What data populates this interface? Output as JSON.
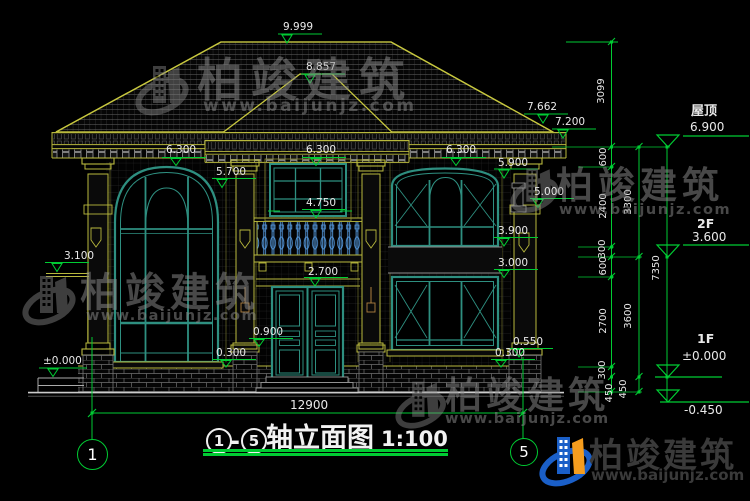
{
  "title_block": {
    "axis_start": "1",
    "axis_end": "5",
    "separator": "-",
    "name": "轴立面图",
    "scale": "1:100"
  },
  "axis_bubbles": {
    "left": "1",
    "right": "5"
  },
  "overall_dimension": "12900",
  "levels": [
    {
      "name": "屋顶",
      "elevation": "6.900"
    },
    {
      "name": "2F",
      "elevation": "3.600"
    },
    {
      "name": "1F",
      "elevation": "±0.000"
    },
    {
      "name": "",
      "elevation": "-0.450"
    }
  ],
  "dimension_chains": {
    "inner": [
      "600",
      "2400",
      "300",
      "600",
      "2700",
      "300",
      "450"
    ],
    "middle": [
      "3300",
      "3600",
      "450"
    ],
    "outer": [
      "7350"
    ],
    "ridge_to_roof": "3099"
  },
  "elevation_marks": [
    "9.999",
    "8.857",
    "7.662",
    "7.200",
    "6.300",
    "6.300",
    "6.300",
    "5.900",
    "5.700",
    "5.000",
    "4.750",
    "3.900",
    "3.100",
    "3.000",
    "2.700",
    "0.900",
    "0.550",
    "0.300",
    "0.300",
    "±0.000"
  ],
  "watermark": {
    "company": "柏竣建筑",
    "website": "www.baijunjz.com"
  },
  "brand": {
    "company": "柏竣建筑",
    "website": "www.baijunjz.com"
  },
  "colors": {
    "dimension_green": "#00cc33",
    "trim_yellow": "#b9b93d",
    "window_teal": "#2e8f80",
    "baluster_blue": "#5599dd",
    "logo_blue": "#1a5fc8",
    "logo_orange": "#f59d1e"
  },
  "labels": [
    {
      "n": "elev-9999",
      "t": "9.999",
      "x": 283,
      "y": 22
    },
    {
      "n": "elev-8857",
      "t": "8.857",
      "x": 306,
      "y": 62
    },
    {
      "n": "elev-7662",
      "t": "7.662",
      "x": 527,
      "y": 102
    },
    {
      "n": "elev-7200",
      "t": "7.200",
      "x": 555,
      "y": 117
    },
    {
      "n": "elev-6300-left",
      "t": "6.300",
      "x": 166,
      "y": 145
    },
    {
      "n": "elev-6300-mid",
      "t": "6.300",
      "x": 306,
      "y": 145
    },
    {
      "n": "elev-6300-right",
      "t": "6.300",
      "x": 446,
      "y": 145
    },
    {
      "n": "elev-5900",
      "t": "5.900",
      "x": 498,
      "y": 158
    },
    {
      "n": "elev-5700",
      "t": "5.700",
      "x": 216,
      "y": 167
    },
    {
      "n": "elev-5000",
      "t": "5.000",
      "x": 534,
      "y": 187
    },
    {
      "n": "elev-4750",
      "t": "4.750",
      "x": 306,
      "y": 198
    },
    {
      "n": "elev-3900",
      "t": "3.900",
      "x": 498,
      "y": 226
    },
    {
      "n": "elev-3100",
      "t": "3.100",
      "x": 64,
      "y": 251
    },
    {
      "n": "elev-3000",
      "t": "3.000",
      "x": 498,
      "y": 258
    },
    {
      "n": "elev-2700",
      "t": "2.700",
      "x": 308,
      "y": 267
    },
    {
      "n": "elev-0900",
      "t": "0.900",
      "x": 253,
      "y": 327
    },
    {
      "n": "elev-0550",
      "t": "0.550",
      "x": 513,
      "y": 337
    },
    {
      "n": "elev-0300-mid",
      "t": "0.300",
      "x": 216,
      "y": 348
    },
    {
      "n": "elev-0300-right",
      "t": "0.300",
      "x": 495,
      "y": 348
    },
    {
      "n": "elev-0000-left",
      "t": "±0.000",
      "x": 43,
      "y": 356
    },
    {
      "n": "dim-12900",
      "t": "12900",
      "x": 290,
      "y": 399,
      "fs": 12
    },
    {
      "n": "level-roof-name",
      "t": "屋顶",
      "x": 691,
      "y": 105,
      "fs": 13,
      "b": 1
    },
    {
      "n": "level-roof-elev",
      "t": "6.900",
      "x": 690,
      "y": 121,
      "fs": 12
    },
    {
      "n": "level-2f-name",
      "t": "2F",
      "x": 697,
      "y": 218,
      "fs": 12.5,
      "b": 1
    },
    {
      "n": "level-2f-elev",
      "t": "3.600",
      "x": 692,
      "y": 231,
      "fs": 12
    },
    {
      "n": "level-1f-name",
      "t": "1F",
      "x": 697,
      "y": 333,
      "fs": 12.5,
      "b": 1
    },
    {
      "n": "level-1f-elev",
      "t": "±0.000",
      "x": 682,
      "y": 350,
      "fs": 12
    },
    {
      "n": "level-foundation-elev",
      "t": "-0.450",
      "x": 684,
      "y": 404,
      "fs": 12
    },
    {
      "n": "chain-3099",
      "t": "3099",
      "cx": 602,
      "cy": 91,
      "rot": 1,
      "fs": 10
    },
    {
      "n": "chain-600-a",
      "t": "600",
      "cx": 604,
      "cy": 157,
      "rot": 1,
      "fs": 10
    },
    {
      "n": "chain-2400",
      "t": "2400",
      "cx": 604,
      "cy": 206,
      "rot": 1,
      "fs": 10
    },
    {
      "n": "chain-300-a",
      "t": "300",
      "cx": 603,
      "cy": 249,
      "rot": 1,
      "fs": 10
    },
    {
      "n": "chain-600-b",
      "t": "600",
      "cx": 604,
      "cy": 266,
      "rot": 1,
      "fs": 10
    },
    {
      "n": "chain-2700",
      "t": "2700",
      "cx": 604,
      "cy": 321,
      "rot": 1,
      "fs": 10
    },
    {
      "n": "chain-300-b",
      "t": "300",
      "cx": 603,
      "cy": 370,
      "rot": 1,
      "fs": 10
    },
    {
      "n": "chain-450-a",
      "t": "450",
      "cx": 610,
      "cy": 393,
      "rot": 1,
      "fs": 10
    },
    {
      "n": "chain-3300",
      "t": "3300",
      "cx": 629,
      "cy": 202,
      "rot": 1,
      "fs": 10
    },
    {
      "n": "chain-3600",
      "t": "3600",
      "cx": 629,
      "cy": 316,
      "rot": 1,
      "fs": 10
    },
    {
      "n": "chain-450-b",
      "t": "450",
      "cx": 624,
      "cy": 389,
      "rot": 1,
      "fs": 10
    },
    {
      "n": "chain-7350",
      "t": "7350",
      "cx": 657,
      "cy": 268,
      "rot": 1,
      "fs": 10
    }
  ]
}
